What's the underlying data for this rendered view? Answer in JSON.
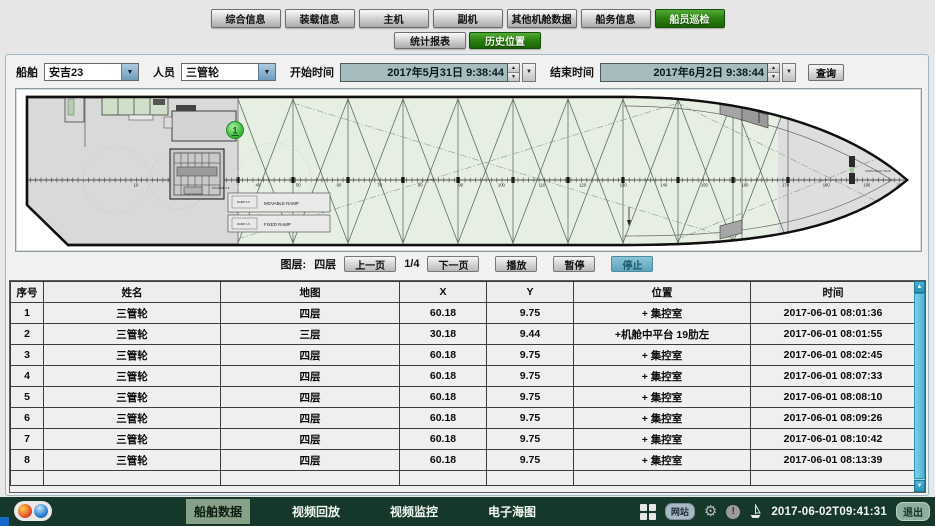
{
  "tabs": {
    "main": [
      {
        "label": "综合信息",
        "active": false
      },
      {
        "label": "装载信息",
        "active": false
      },
      {
        "label": "主机",
        "active": false
      },
      {
        "label": "副机",
        "active": false
      },
      {
        "label": "其他机舱数据",
        "active": false
      },
      {
        "label": "船务信息",
        "active": false
      },
      {
        "label": "船员巡检",
        "active": true
      }
    ],
    "sub": [
      {
        "label": "统计报表",
        "active": false
      },
      {
        "label": "历史位置",
        "active": true
      }
    ]
  },
  "filters": {
    "ship_label": "船舶",
    "ship_value": "安吉23",
    "person_label": "人员",
    "person_value": "三管轮",
    "start_label": "开始时间",
    "start_value": "2017年5月31日 9:38:44",
    "end_label": "结束时间",
    "end_value": "2017年6月2日 9:38:44",
    "query_label": "查询"
  },
  "map": {
    "marker_label": "1",
    "movable_ramp_label": "MOVABLE RAMP",
    "fixed_ramp_label": "FIXED RAMP",
    "ramp_note_1": "RAMP 4-5",
    "ramp_note_2": "RAMP 4-5",
    "fore_peak_label": "FORE PEAK TANK",
    "frame_scale": {
      "start": 10,
      "end": 200,
      "step": 10
    }
  },
  "pager": {
    "layer_label": "图层:",
    "layer_value": "四层",
    "prev": "上一页",
    "page": "1/4",
    "next": "下一页",
    "play": "播放",
    "pause": "暂停",
    "stop": "停止"
  },
  "table": {
    "columns": [
      "序号",
      "姓名",
      "地图",
      "X",
      "Y",
      "位置",
      "时间"
    ],
    "rows": [
      [
        "1",
        "三管轮",
        "四层",
        "60.18",
        "9.75",
        "+ 集控室",
        "2017-06-01 08:01:36"
      ],
      [
        "2",
        "三管轮",
        "三层",
        "30.18",
        "9.44",
        "+机舱中平台 19肋左",
        "2017-06-01 08:01:55"
      ],
      [
        "3",
        "三管轮",
        "四层",
        "60.18",
        "9.75",
        "+ 集控室",
        "2017-06-01 08:02:45"
      ],
      [
        "4",
        "三管轮",
        "四层",
        "60.18",
        "9.75",
        "+ 集控室",
        "2017-06-01 08:07:33"
      ],
      [
        "5",
        "三管轮",
        "四层",
        "60.18",
        "9.75",
        "+ 集控室",
        "2017-06-01 08:08:10"
      ],
      [
        "6",
        "三管轮",
        "四层",
        "60.18",
        "9.75",
        "+ 集控室",
        "2017-06-01 08:09:26"
      ],
      [
        "7",
        "三管轮",
        "四层",
        "60.18",
        "9.75",
        "+ 集控室",
        "2017-06-01 08:10:42"
      ],
      [
        "8",
        "三管轮",
        "四层",
        "60.18",
        "9.75",
        "+ 集控室",
        "2017-06-01 08:13:39"
      ]
    ]
  },
  "taskbar": {
    "items": [
      {
        "label": "船舶数据",
        "active": true
      },
      {
        "label": "视频回放",
        "active": false
      },
      {
        "label": "视频监控",
        "active": false
      },
      {
        "label": "电子海图",
        "active": false
      }
    ],
    "site_badge": "网站",
    "time": "2017-06-02T09:41:31",
    "exit_label": "退出"
  }
}
